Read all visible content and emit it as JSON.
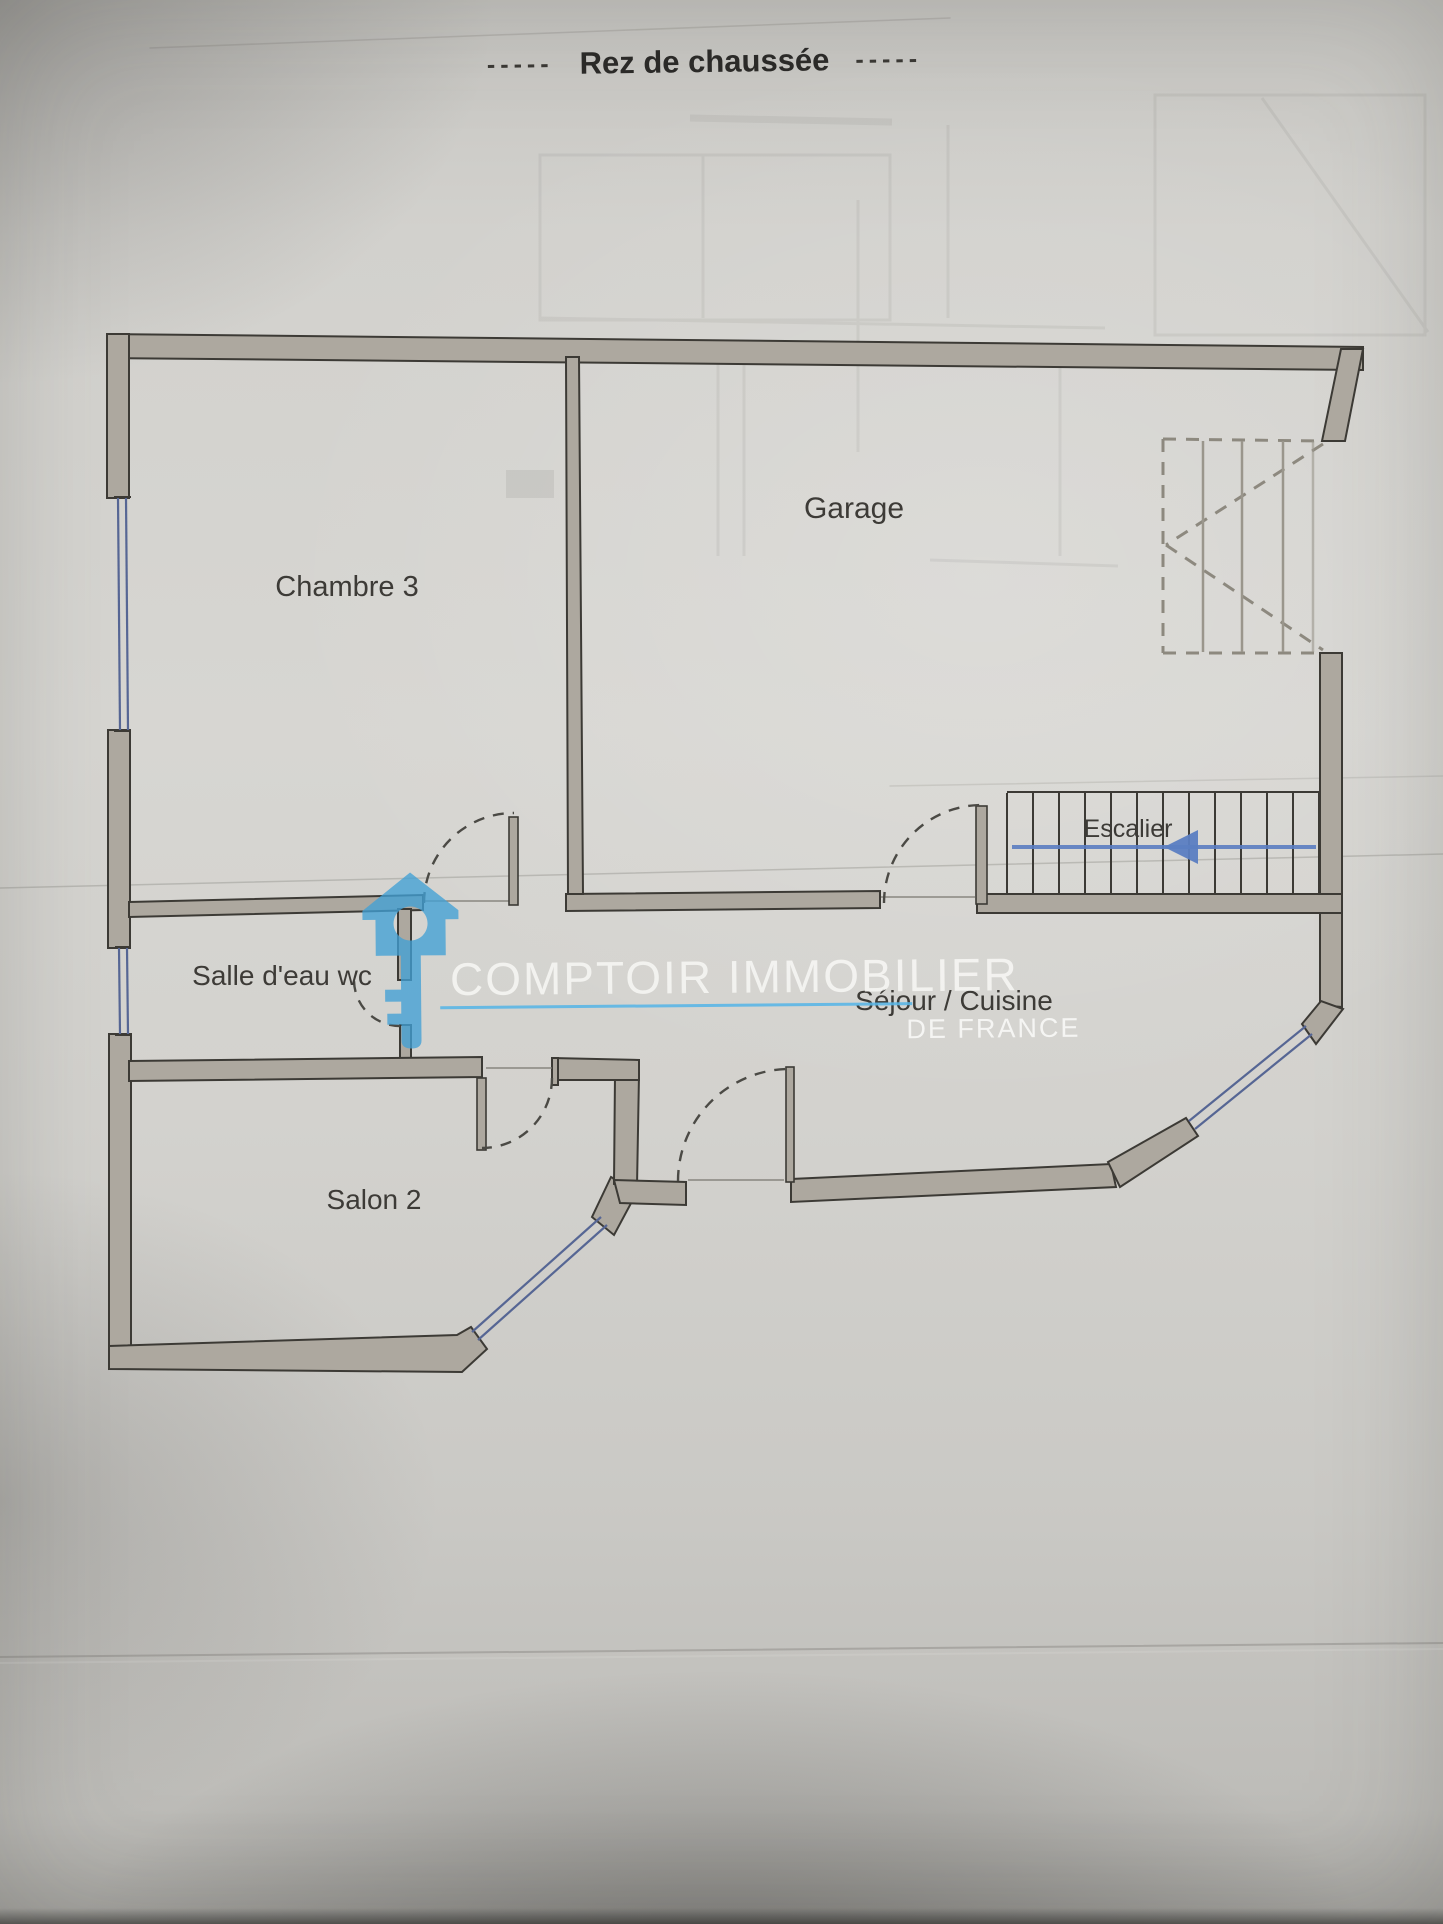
{
  "title": {
    "left_dashes": "-----",
    "text": "Rez de chaussée",
    "right_dashes": "-----"
  },
  "rooms": {
    "chambre3": "Chambre 3",
    "garage": "Garage",
    "salle_deau_wc": "Salle d'eau wc",
    "sejour_cuisine": "Séjour / Cuisine",
    "salon2": "Salon 2",
    "escalier": "Escalier"
  },
  "watermark": {
    "brand": "COMPTOIR IMMOBILIER",
    "subtitle": "DE FRANCE",
    "logo_icon": "house-key-icon"
  },
  "colors": {
    "paper": "#d4d3cf",
    "wall_fill": "#ada89f",
    "wall_line": "#3c3a35",
    "window_blue": "#566694",
    "stair_arrow_blue": "#5b7ec2",
    "watermark_underline_blue": "#58b5e6",
    "logo_blue": "#41a0d5",
    "label_text": "#3d3b37"
  }
}
